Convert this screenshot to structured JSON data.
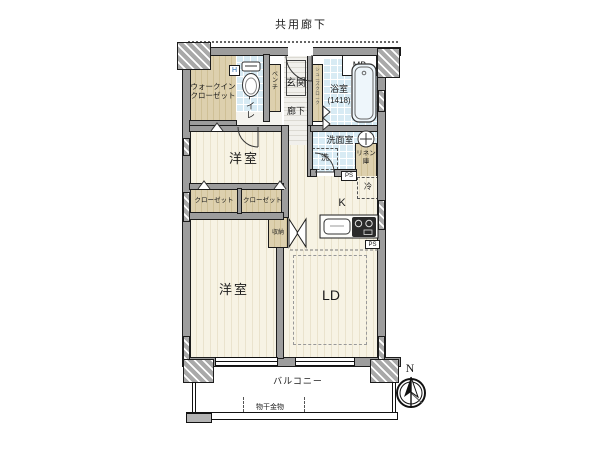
{
  "plan": {
    "shared_corridor": "共用廊下",
    "mb": "MB",
    "walk_in_closet_line1": "ウォークイン",
    "walk_in_closet_line2": "クローゼット",
    "toilet": "トイレ",
    "bench": "ベンチ",
    "entrance": "玄関",
    "shoe_closet": "シューズクローク",
    "hallway": "廊下",
    "bathroom": "浴室",
    "bathroom_size": "(1418)",
    "washroom": "洗面室",
    "washer": "洗",
    "linen_line1": "リネン",
    "linen_line2": "庫",
    "ps_upper": "PS",
    "ps_lower": "PS",
    "fridge": "冷",
    "kitchen": "K",
    "bedroom_upper": "洋室",
    "closet_left": "クローゼット",
    "closet_right": "クローゼット",
    "hanger_mark": "H",
    "storage": "収納",
    "bedroom_lower": "洋室",
    "living_dining": "LD",
    "balcony": "バルコニー",
    "laundry_hardware": "物干金物",
    "north": "N"
  },
  "colors": {
    "wall": "#9d9d9d",
    "floor_cream": "#f7f3e4",
    "floor_tan": "#ddd0ae",
    "floor_tile": "#d8ebf4",
    "outline": "#1c1c1c"
  }
}
